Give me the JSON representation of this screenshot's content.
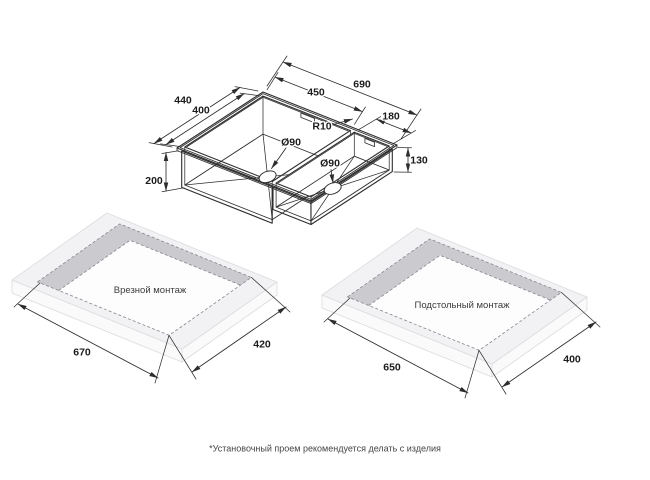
{
  "diagram": {
    "sink": {
      "dims": {
        "overall_length": "690",
        "main_bowl_length": "450",
        "small_bowl_length": "180",
        "overall_width": "440",
        "main_bowl_width": "400",
        "main_bowl_depth": "200",
        "small_bowl_depth": "130",
        "corner_radius": "R10",
        "main_drain_diameter": "Ø90",
        "small_drain_diameter": "Ø90"
      }
    },
    "mounting_inset": {
      "title": "Врезной монтаж",
      "length": "670",
      "width": "420"
    },
    "mounting_undermount": {
      "title": "Подстольный монтаж",
      "length": "650",
      "width": "400"
    },
    "footnote": "*Установочный проем рекомендуется делать с изделия",
    "colors": {
      "line": "#2d2d2d",
      "slab_top": "#f2f2f4",
      "band": "#cbcbcf",
      "background": "#ffffff"
    }
  }
}
